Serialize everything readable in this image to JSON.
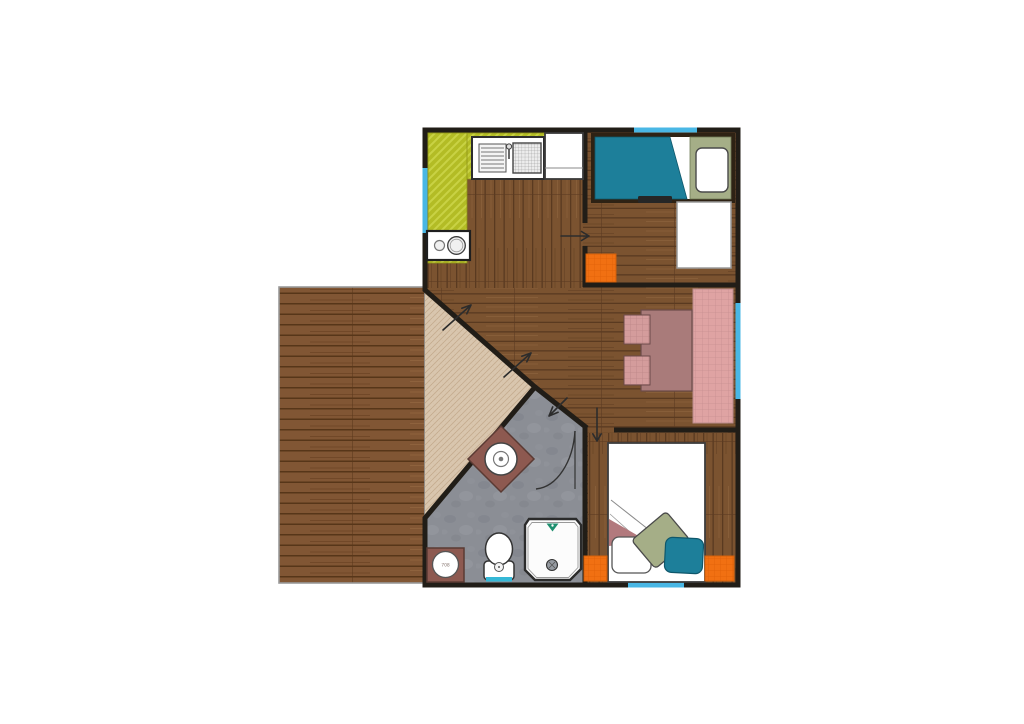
{
  "plan": {
    "washer_label": "708"
  },
  "colors": {
    "wall": "#211d17",
    "window": "#49b7e5",
    "wood_floor": "#7b5330",
    "deck_wood": "#815634",
    "porch_deck": "#d9c6ae",
    "bath_floor": "#8b8e95",
    "counter_olive": "#b3bc25",
    "bed_teal": "#1d7f9a",
    "bed_sage": "#a5ae87",
    "rug_orange": "#f17012",
    "rug_pink": "#dfa3a3",
    "sofa_mauve": "#a97b7a",
    "cushion_pink": "#d49c9c",
    "vanity_brown": "#8d5950",
    "blanket_mauve": "#b2797d",
    "pillow_teal": "#1d7f9a",
    "toilet_water": "#35b8d6",
    "shower_head_green": "#1f8f6f",
    "fixture_white": "#ffffff"
  }
}
